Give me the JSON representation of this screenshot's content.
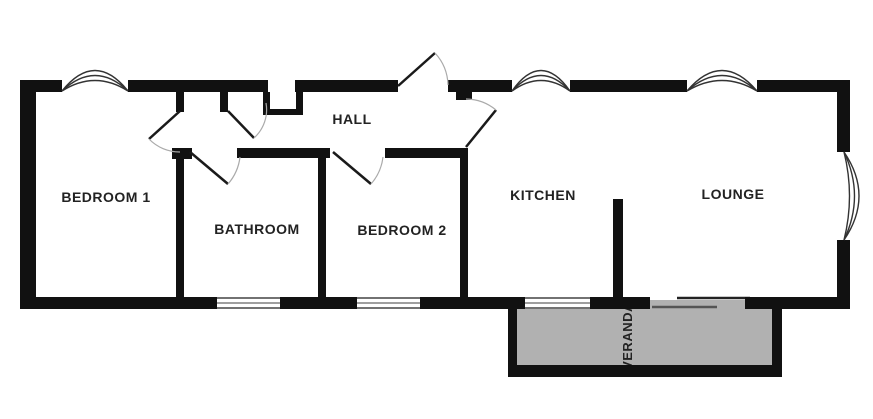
{
  "plan": {
    "title": "Floor plan",
    "rooms": {
      "bedroom1": {
        "label": "BEDROOM 1"
      },
      "bathroom": {
        "label": "BATHROOM"
      },
      "bedroom2": {
        "label": "BEDROOM 2"
      },
      "hall": {
        "label": "HALL"
      },
      "kitchen": {
        "label": "KITCHEN"
      },
      "lounge": {
        "label": "LOUNGE"
      },
      "veranda": {
        "label": "VERANDA"
      }
    },
    "colors": {
      "wall": "#111111",
      "veranda_fill": "#b1b1b1",
      "label_text": "#222222",
      "door_arc": "#aaaaaa",
      "window_line": "#333333",
      "background": "#ffffff"
    }
  }
}
